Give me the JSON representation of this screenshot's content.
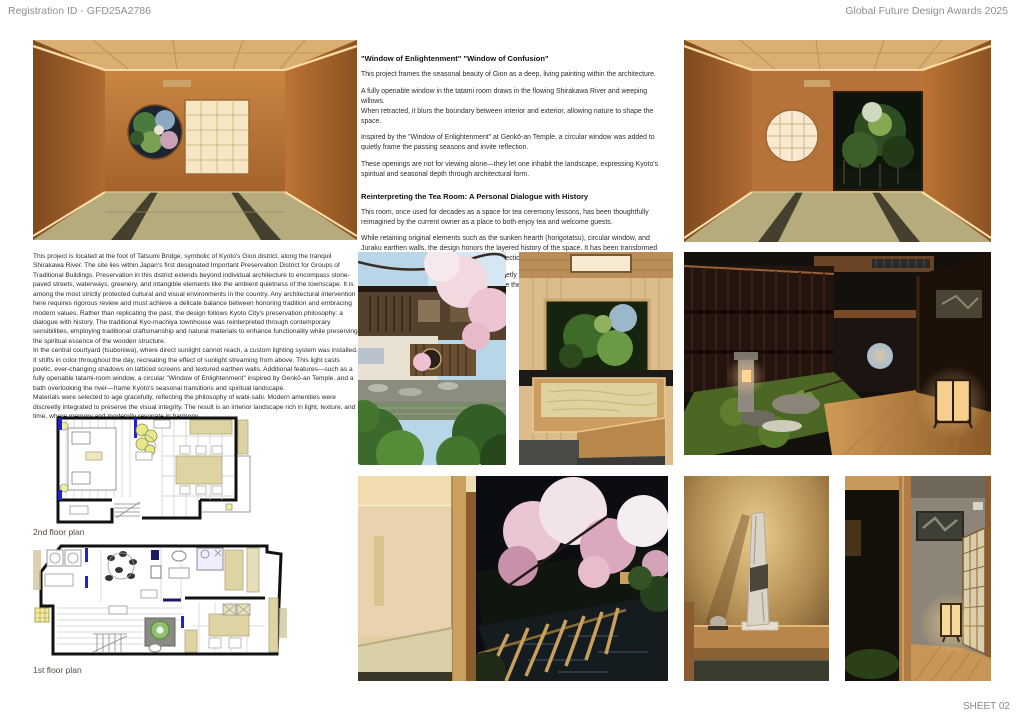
{
  "header": {
    "registration_id": "Registration ID - GFD25A2786",
    "award_title": "Global Future Design Awards 2025"
  },
  "footer": {
    "sheet_label": "SHEET 02"
  },
  "sections": {
    "window": {
      "heading": "\"Window of Enlightenment\" \"Window of Confusion\"",
      "paragraphs": [
        "This project frames the seasonal beauty of Gion as a deep, living painting within the architecture.",
        "A fully openable window in the tatami room draws in the flowing Shirakawa River and weeping willows.\nWhen retracted, it blurs the boundary between interior and exterior, allowing nature to shape the space.",
        "Inspired by the \"Window of Enlightenment\" at Genkō-an Temple, a circular window was added to quietly frame the passing seasons and invite reflection.",
        "These openings are not for viewing alone—they let one inhabit the landscape, expressing Kyoto's spiritual and seasonal depth through architectural form."
      ]
    },
    "tea_room": {
      "heading": "Reinterpreting the Tea Room: A Personal Dialogue with History",
      "paragraphs": [
        "This room, once used for decades as a space for tea ceremony lessons, has been thoughtfully reimagined by the current owner as a place to both enjoy tea and welcome guests.",
        "While retaining original elements such as the sunken hearth (horigotatsu), circular window, and Juraku earthen walls, the design honors the layered history of the space. It has been transformed into a quiet sanctuary—a place for personal reflection and hospitality.",
        "Once open to many, the room now breathes quietly under the care of one. In this transformation lies a subtle sense of privilege and reverence, where the past and present harmoniously converge."
      ]
    },
    "project": {
      "paragraphs": [
        "This project is located at the foot of Tatsumi Bridge, symbolic of Kyoto's Gion district, along the tranquil Shirakawa River. The site lies within Japan's first designated Important Preservation District for Groups of Traditional Buildings. Preservation in this district extends beyond individual architecture to encompass stone-paved streets, waterways, greenery, and intangible elements like the ambient quietness of the townscape. It is among the most strictly protected cultural and visual environments in the country. Any architectural intervention here requires rigorous review and must achieve a delicate balance between honoring tradition and embracing modern values. Rather than replicating the past, the design follows Kyoto City's preservation philosophy: a dialogue with history. The traditional Kyo-machiya townhouse was reinterpreted through contemporary sensibilities, employing traditional craftsmanship and natural materials to enhance functionality while preserving the spiritual essence of the wooden structure.",
        "In the central courtyard (tsuboniwa), where direct sunlight cannot reach, a custom lighting system was installed. It shifts in color throughout the day, recreating the effect of sunlight streaming from above. This light casts poetic, ever-changing shadows on latticed screens and textured earthen walls. Additional features—such as a fully openable tatami-room window, a circular \"Window of Enlightenment\" inspired by Genkō-an Temple, and a bath overlooking the river—frame Kyoto's seasonal transitions and spiritual landscape.",
        "Materials were selected to age gracefully, reflecting the philosophy of wabi-sabi. Modern amenities were discreetly integrated to preserve the visual integrity. The result is an interior landscape rich in light, texture, and time, where memory and modernity resonate in harmony."
      ]
    }
  },
  "plans": {
    "second_floor": {
      "label": "2nd floor plan"
    },
    "first_floor": {
      "label": "1st floor plan"
    }
  },
  "colors": {
    "plan_furniture_tan": "#ddd3a3",
    "plan_accent_blue": "#2222cc",
    "plan_moss_green": "#8fbf6f",
    "room_wall_orange": "#b4702f",
    "tatami_green": "#b5ab7c",
    "lamp_glow": "#f6cf8e"
  }
}
